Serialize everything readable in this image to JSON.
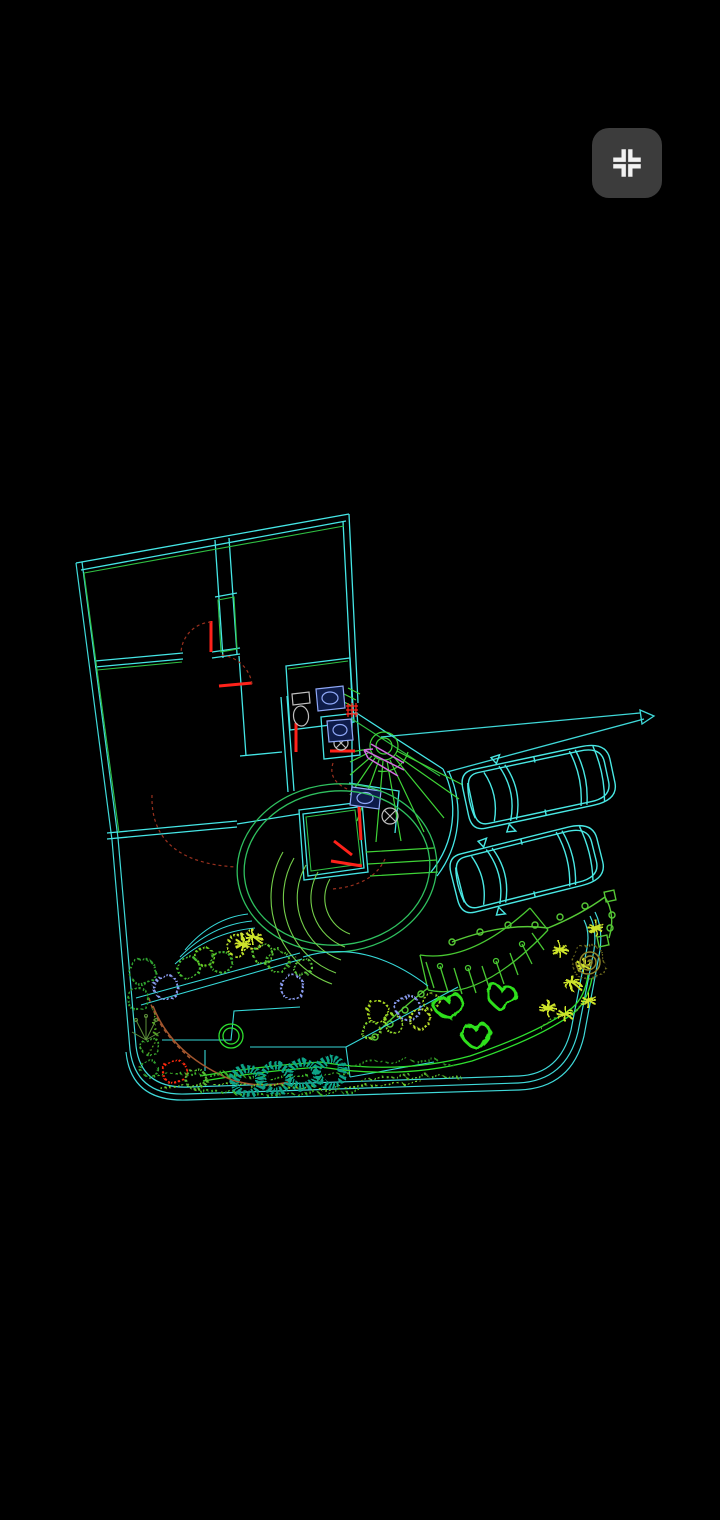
{
  "app": {
    "name": "cad-drawing-viewer",
    "canvas_bg": "#000000"
  },
  "toolbar": {
    "fit_button": {
      "icon": "fit-to-screen-icon",
      "label": "Zoom extents",
      "button_bg": "#3c3c3c",
      "glyph_color": "#f2f2f2"
    }
  },
  "drawing": {
    "type": "cad-site-plan",
    "description": "Wireframe floor plan of a house with curved stair, two parked cars, driveway and landscaped garden on black model space",
    "palette": {
      "canvas_bg": "#000000",
      "button_bg": "#3c3c3c",
      "glyph": "#f2f2f2",
      "wall": "#45e6e6",
      "boundary": "#3fd9d9",
      "accent_green": "#2fbf42",
      "stair_green": "#3fd437",
      "door_red": "#ff221a",
      "arc_dark_red": "#99301e",
      "magenta": "#d36ee0",
      "fixture_gray": "#bfbfbf",
      "fixture_blue": "#8fa8f7",
      "patio_green": "#2fc05f",
      "amphi_green": "#74cf4a",
      "car_cyan": "#49e8e4",
      "drive_cyan": "#3fd8d8",
      "fence_green": "#56c836",
      "pergola_green": "#49c832",
      "donut_teal": "#0ea387",
      "heart_green": "#2ee01a",
      "path_cyan": "#36d8d8",
      "garden_green": "#2fdf2f",
      "brown": "#a3562e",
      "spiral_olive": "#8f852a",
      "star_yellow": "#cde32a",
      "grass_green": "#3db32a",
      "branch_green": "#5d8f3a"
    },
    "cars": [
      {
        "x": 540,
        "y": 786,
        "rot": -12
      },
      {
        "x": 528,
        "y": 868,
        "rot": -14
      }
    ],
    "garden": {
      "bushes": [
        {
          "x": 143,
          "y": 972,
          "r": 13,
          "c": "#2f9e2f"
        },
        {
          "x": 166,
          "y": 987,
          "r": 12,
          "c": "#8a9cf0"
        },
        {
          "x": 189,
          "y": 968,
          "r": 11,
          "c": "#44bb33"
        },
        {
          "x": 205,
          "y": 957,
          "r": 9,
          "c": "#66cc22"
        },
        {
          "x": 221,
          "y": 962,
          "r": 11,
          "c": "#3fae2f"
        },
        {
          "x": 237,
          "y": 946,
          "r": 10,
          "c": "#b8e02a"
        },
        {
          "x": 251,
          "y": 940,
          "r": 9,
          "c": "#cfe23a"
        },
        {
          "x": 263,
          "y": 954,
          "r": 10,
          "c": "#5cc832"
        },
        {
          "x": 278,
          "y": 961,
          "r": 11,
          "c": "#49b42e"
        },
        {
          "x": 292,
          "y": 987,
          "r": 12,
          "c": "#8a9cf0"
        },
        {
          "x": 303,
          "y": 967,
          "r": 9,
          "c": "#58c43a"
        },
        {
          "x": 138,
          "y": 999,
          "r": 11,
          "c": "#2f9e2f"
        },
        {
          "x": 150,
          "y": 1046,
          "r": 9,
          "c": "#3aa52f"
        },
        {
          "x": 149,
          "y": 1068,
          "r": 8,
          "c": "#2f9e2f"
        },
        {
          "x": 175,
          "y": 1072,
          "r": 12,
          "c": "#ff2a10"
        },
        {
          "x": 196,
          "y": 1079,
          "r": 10,
          "c": "#55bb33"
        },
        {
          "x": 378,
          "y": 1012,
          "r": 11,
          "c": "#a8d820"
        },
        {
          "x": 394,
          "y": 1024,
          "r": 9,
          "c": "#8fd42a"
        },
        {
          "x": 408,
          "y": 1008,
          "r": 12,
          "c": "#8a9cf0"
        },
        {
          "x": 420,
          "y": 1019,
          "r": 10,
          "c": "#b8e02a"
        },
        {
          "x": 371,
          "y": 1031,
          "r": 9,
          "c": "#7fcf2a"
        },
        {
          "x": 432,
          "y": 1002,
          "r": 8,
          "c": "#98d428"
        }
      ],
      "donut_shrubs": [
        {
          "x": 247,
          "y": 1081,
          "r": 13
        },
        {
          "x": 275,
          "y": 1078,
          "r": 13
        },
        {
          "x": 303,
          "y": 1075,
          "r": 13
        },
        {
          "x": 331,
          "y": 1072,
          "r": 13
        }
      ],
      "stepping_stones": [
        {
          "x": 449,
          "y": 1007,
          "rot": -15
        },
        {
          "x": 501,
          "y": 997,
          "rot": 5
        },
        {
          "x": 476,
          "y": 1036,
          "rot": -5
        }
      ],
      "star_plants": [
        {
          "x": 560,
          "y": 950
        },
        {
          "x": 573,
          "y": 984
        },
        {
          "x": 588,
          "y": 1000
        },
        {
          "x": 548,
          "y": 1008
        },
        {
          "x": 596,
          "y": 928
        },
        {
          "x": 565,
          "y": 1014
        },
        {
          "x": 584,
          "y": 966
        },
        {
          "x": 243,
          "y": 944
        },
        {
          "x": 253,
          "y": 937
        }
      ]
    }
  }
}
